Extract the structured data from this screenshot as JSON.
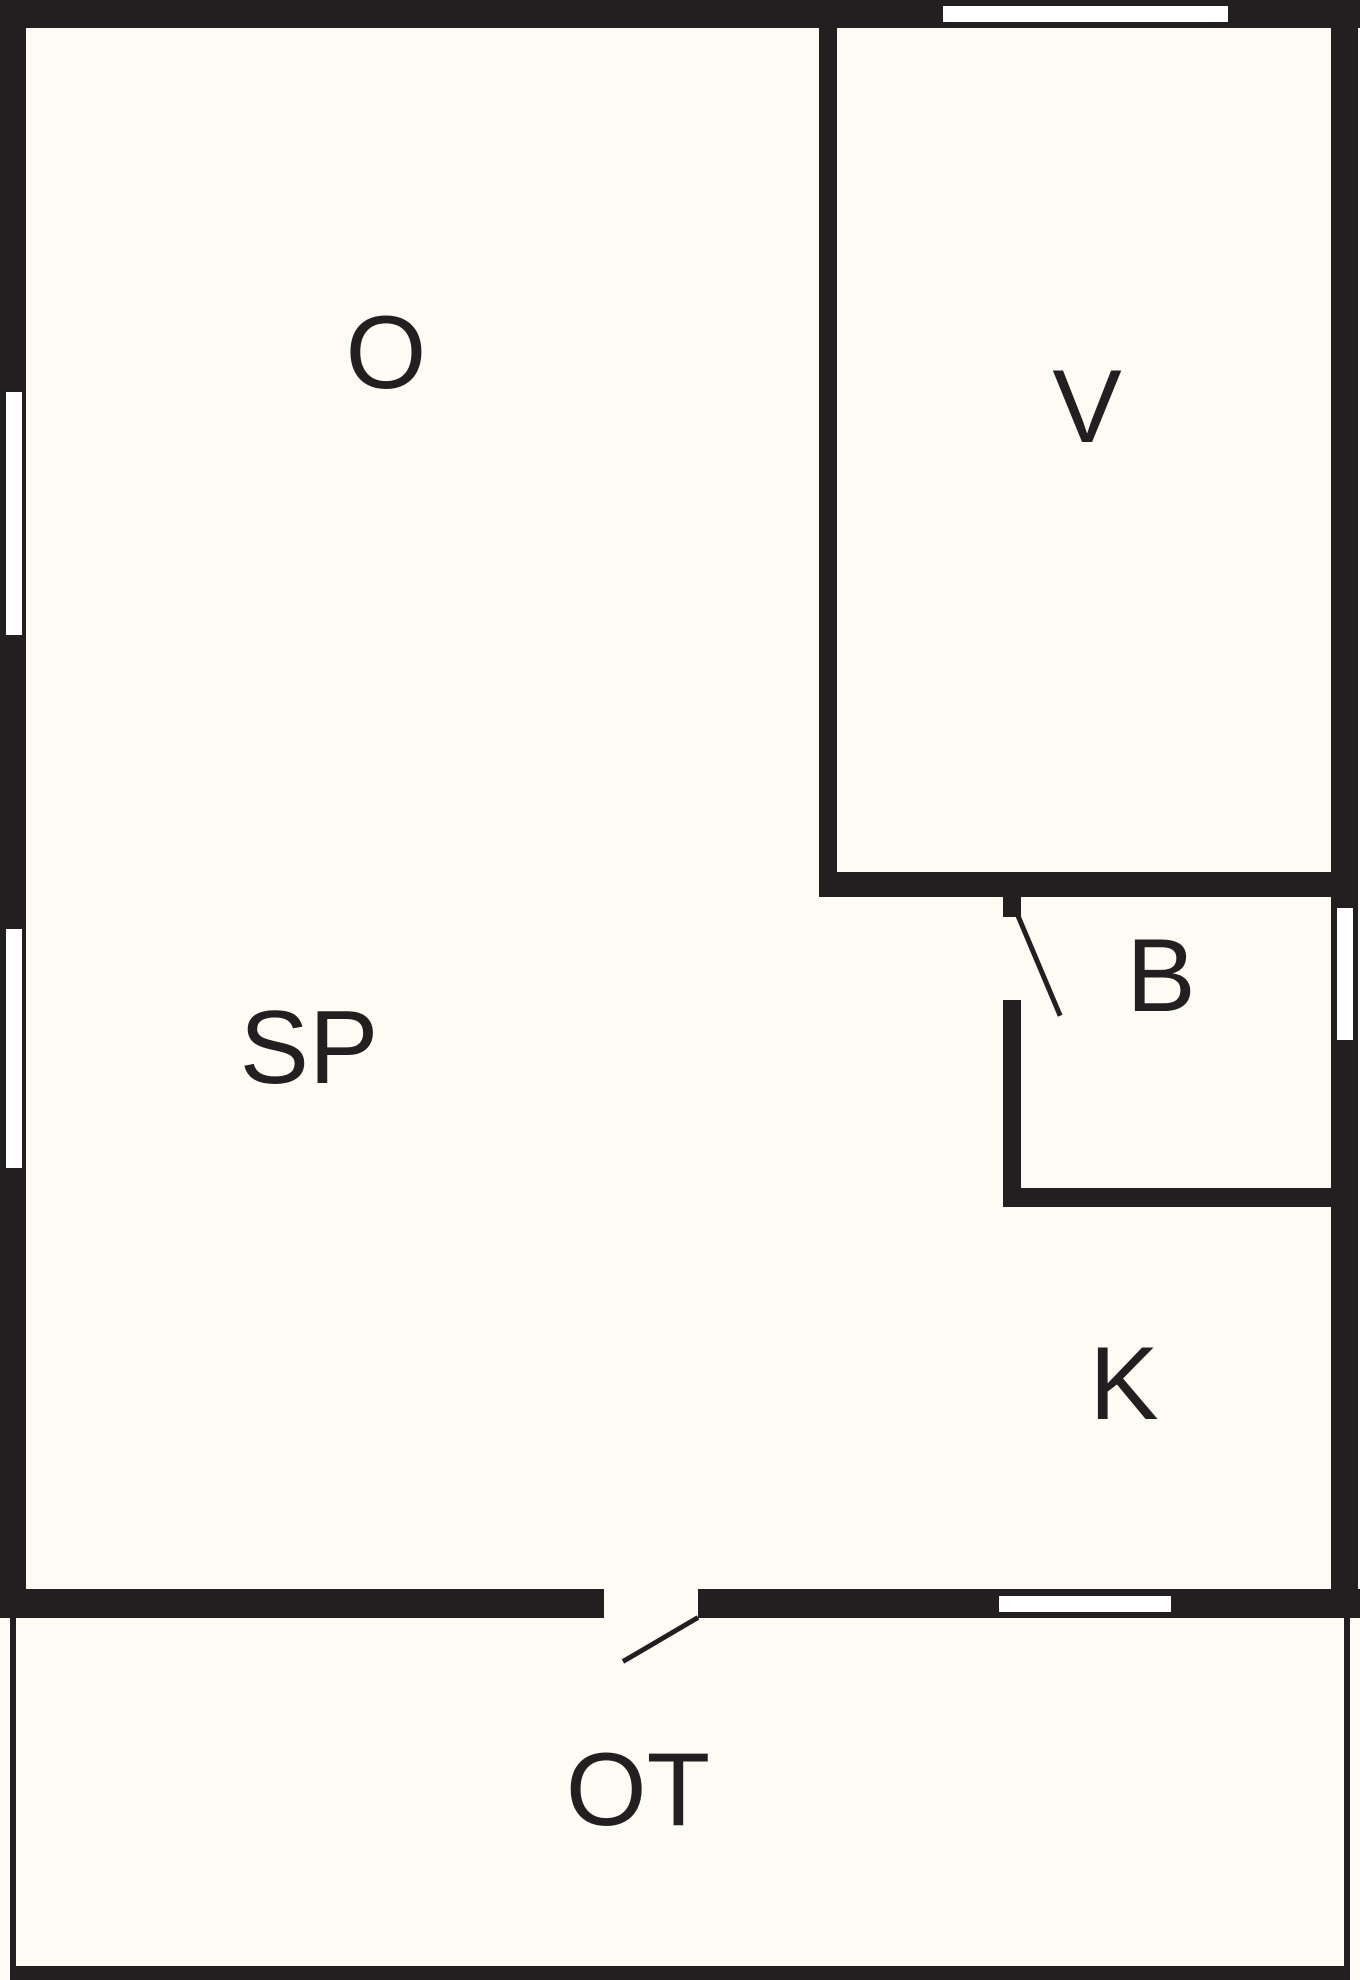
{
  "title": "floor-plan",
  "colors": {
    "wall": "#231f20",
    "background": "#fcfcf5",
    "window": "#ffffff"
  },
  "rooms": {
    "o": {
      "label": "O"
    },
    "v": {
      "label": "V"
    },
    "sp": {
      "label": "SP"
    },
    "b": {
      "label": "B"
    },
    "k": {
      "label": "K"
    },
    "ot": {
      "label": "OT"
    }
  }
}
